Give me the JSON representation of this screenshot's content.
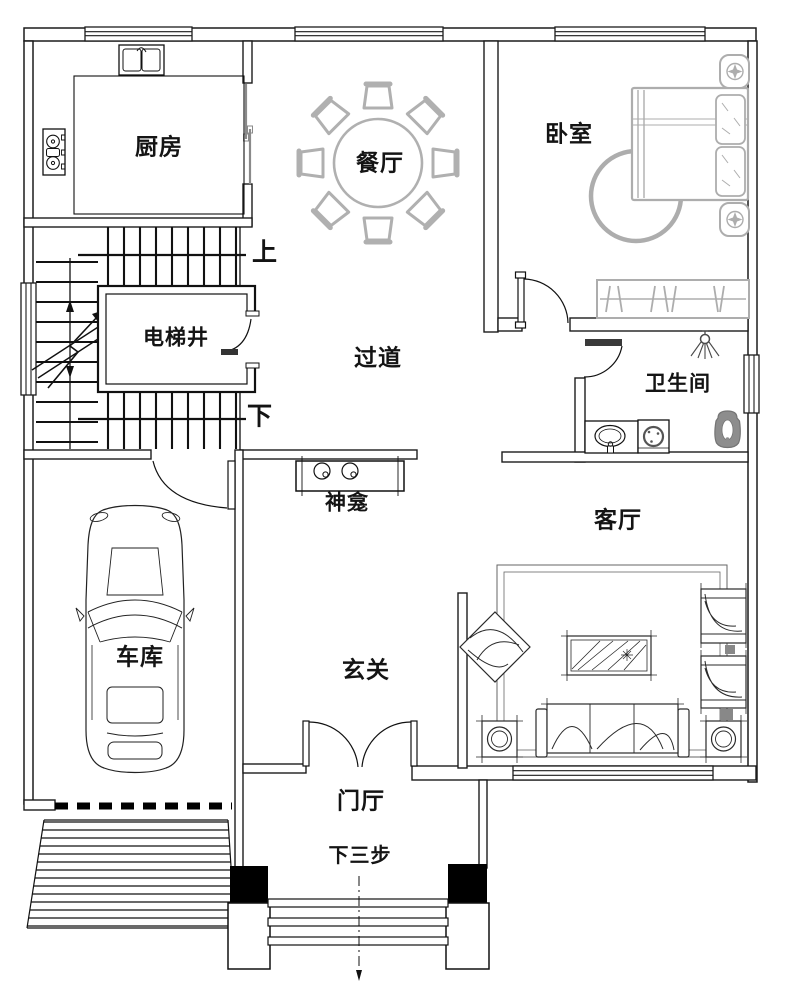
{
  "plan": {
    "rooms": {
      "kitchen": "厨房",
      "dining": "餐厅",
      "bedroom": "卧室",
      "elevator": "电梯井",
      "corridor": "过道",
      "bathroom": "卫生间",
      "shrine": "神龛",
      "living": "客厅",
      "garage": "车库",
      "entry": "玄关",
      "foyer": "门厅"
    },
    "stairs": {
      "up": "上",
      "down": "下"
    },
    "entrance": {
      "steps_note": "下三步"
    },
    "colors": {
      "line": "#1c1c1c",
      "furniture_gray": "#b0b0b0",
      "background": "#ffffff"
    }
  }
}
